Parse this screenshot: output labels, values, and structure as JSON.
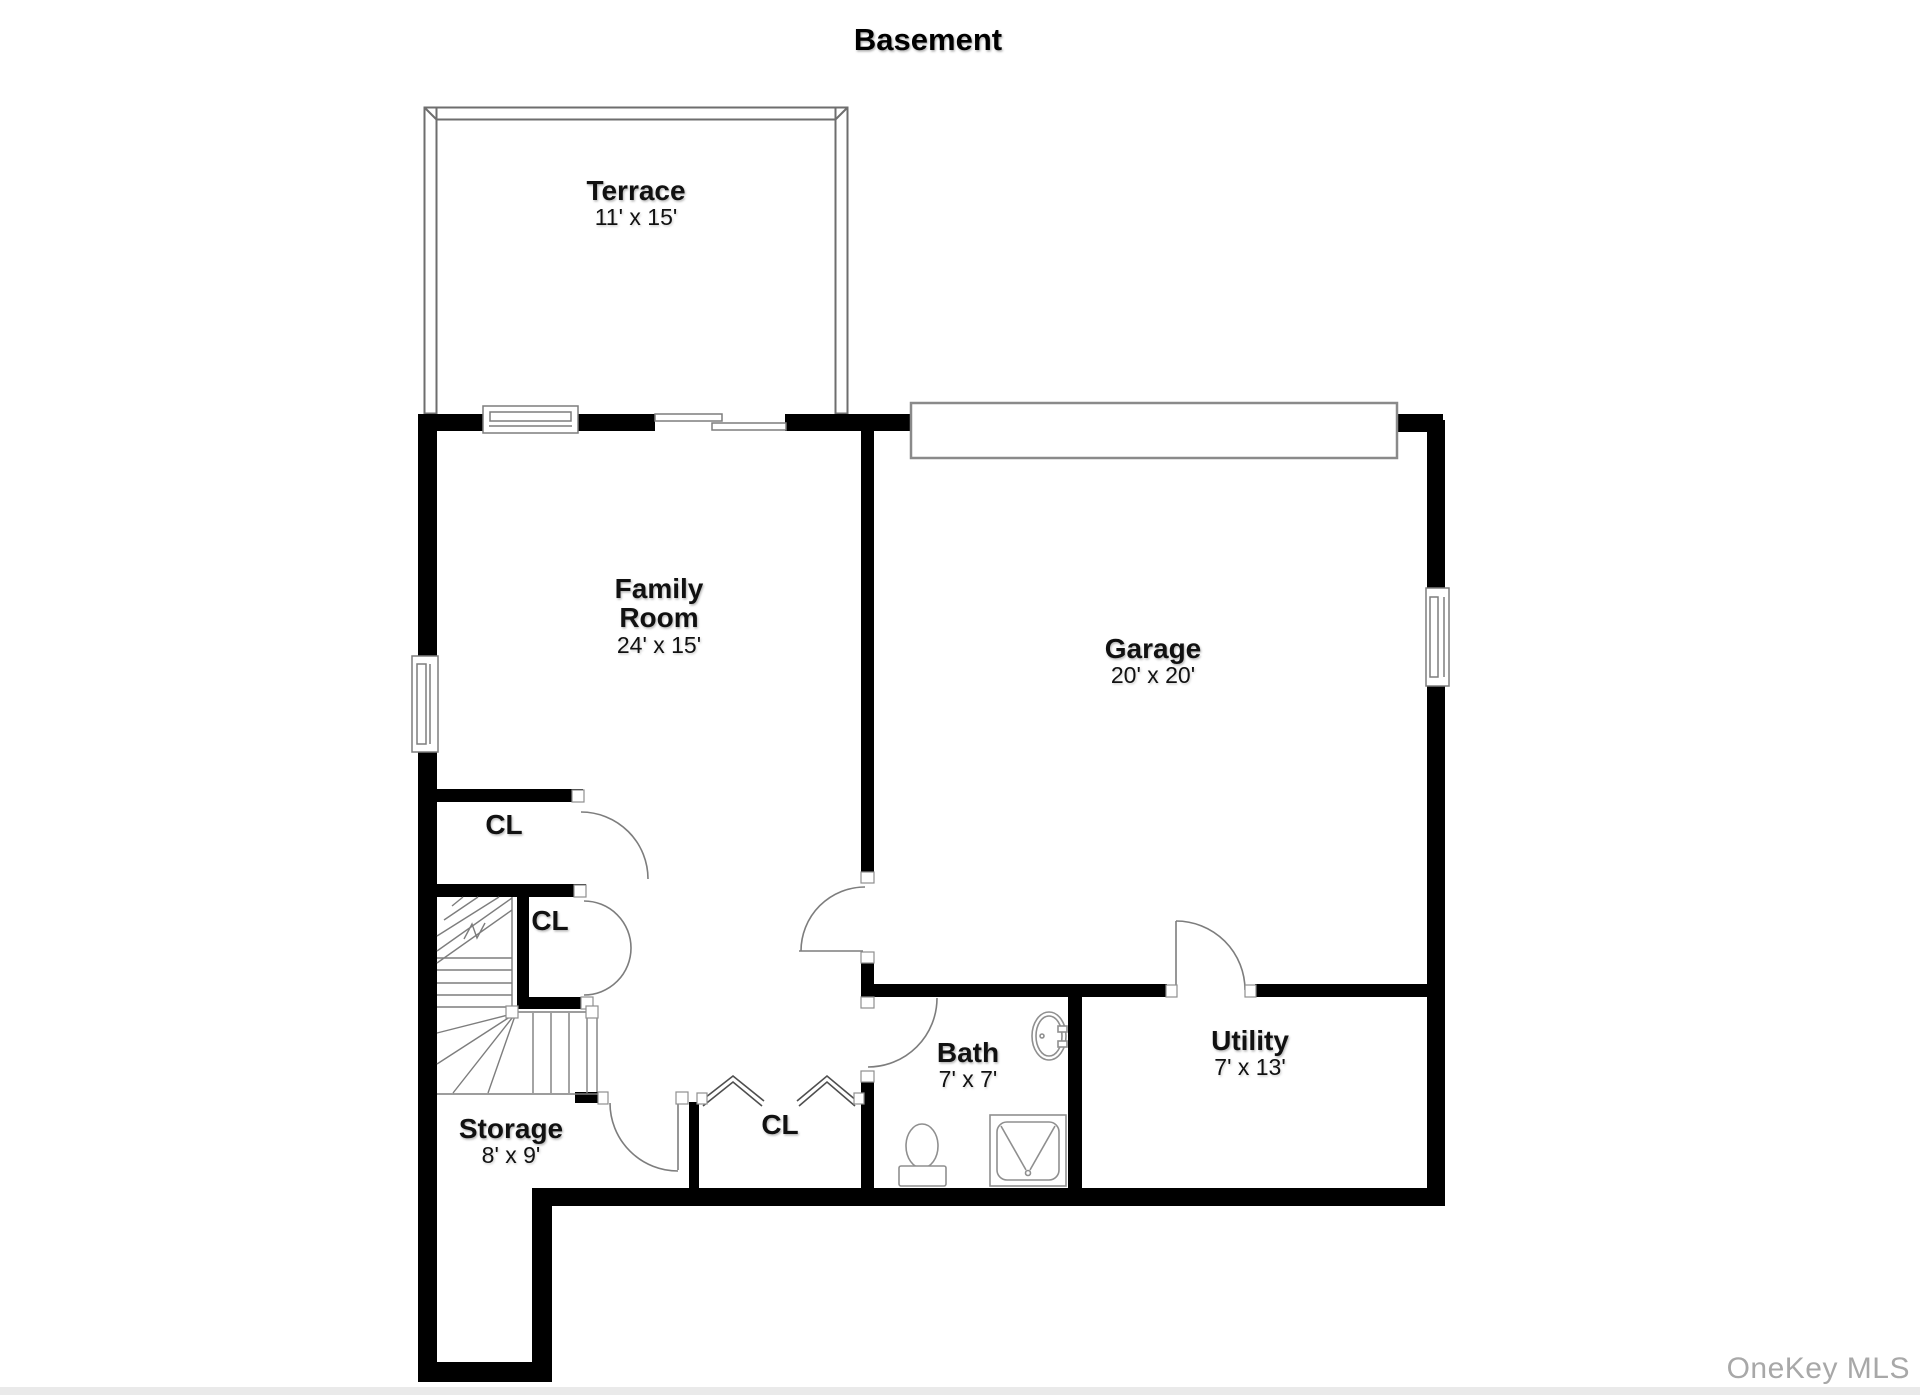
{
  "title": "Basement",
  "watermark": "OneKey MLS",
  "colors": {
    "wall": "#000000",
    "line": "#7d7d7d",
    "fixture": "#8f8f8f",
    "terrace": "#6e6e6e",
    "bifold": "#4f4f4f",
    "watermark": "#a8a8a8"
  },
  "rooms": {
    "terrace": {
      "name": "Terrace",
      "dims": "11' x 15'"
    },
    "family_room": {
      "name": "Family Room",
      "dims": "24' x 15'"
    },
    "garage": {
      "name": "Garage",
      "dims": "20' x 20'"
    },
    "bath": {
      "name": "Bath",
      "dims": "7' x 7'"
    },
    "utility": {
      "name": "Utility",
      "dims": "7' x 13'"
    },
    "storage": {
      "name": "Storage",
      "dims": "8' x 9'"
    }
  },
  "closets": {
    "upper": "CL",
    "middle": "CL",
    "hall": "CL"
  }
}
